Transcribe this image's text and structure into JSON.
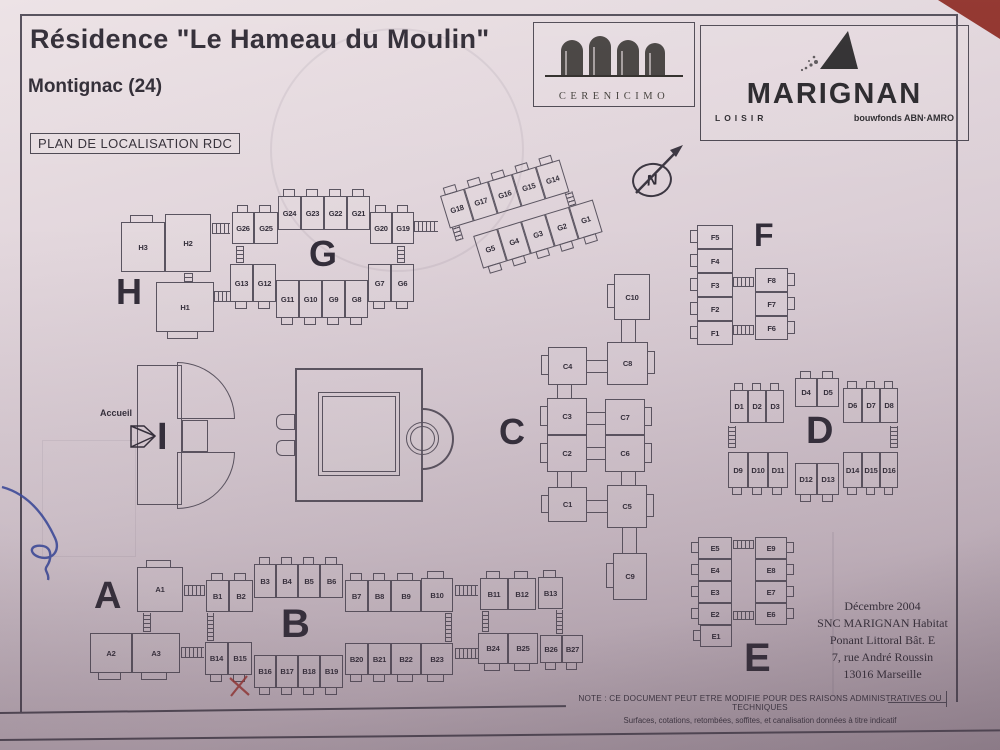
{
  "document": {
    "title": "Résidence \"Le Hameau du Moulin\"",
    "location": "Montignac (24)",
    "plan_label": "PLAN DE LOCALISATION RDC",
    "reception_label": "Accueil",
    "compass_label": "N"
  },
  "logos": {
    "cerenicimo": {
      "name": "CERENICIMO"
    },
    "marignan": {
      "name": "MARIGNAN",
      "tagline_left": "LOISIR",
      "tagline_right": "bouwfonds ABN·AMRO"
    }
  },
  "buildings": [
    {
      "letter": "A",
      "units": [
        "A1",
        "A2",
        "A3"
      ]
    },
    {
      "letter": "B",
      "units": [
        "B1",
        "B2",
        "B3",
        "B4",
        "B5",
        "B6",
        "B7",
        "B8",
        "B9",
        "B10",
        "B11",
        "B12",
        "B13",
        "B14",
        "B15",
        "B16",
        "B17",
        "B18",
        "B19",
        "B20",
        "B21",
        "B22",
        "B23",
        "B24",
        "B25",
        "B26",
        "B27"
      ]
    },
    {
      "letter": "C",
      "units": [
        "C1",
        "C2",
        "C3",
        "C4",
        "C5",
        "C6",
        "C7",
        "C8",
        "C9",
        "C10"
      ]
    },
    {
      "letter": "D",
      "units": [
        "D1",
        "D2",
        "D3",
        "D4",
        "D5",
        "D6",
        "D7",
        "D8",
        "D9",
        "D10",
        "D11",
        "D12",
        "D13",
        "D14",
        "D15",
        "D16"
      ]
    },
    {
      "letter": "E",
      "units": [
        "E1",
        "E2",
        "E3",
        "E4",
        "E5",
        "E6",
        "E7",
        "E8",
        "E9"
      ]
    },
    {
      "letter": "F",
      "units": [
        "F1",
        "F2",
        "F3",
        "F4",
        "F5",
        "F6",
        "F7",
        "F8"
      ]
    },
    {
      "letter": "G",
      "units": [
        "G1",
        "G2",
        "G3",
        "G4",
        "G5",
        "G6",
        "G7",
        "G8",
        "G9",
        "G10",
        "G11",
        "G12",
        "G13",
        "G14",
        "G15",
        "G16",
        "G17",
        "G18",
        "G19",
        "G20",
        "G21",
        "G22",
        "G23",
        "G24",
        "G25",
        "G26"
      ]
    },
    {
      "letter": "H",
      "units": [
        "H1",
        "H2",
        "H3"
      ]
    },
    {
      "letter": "I",
      "units": []
    }
  ],
  "footer": {
    "date": "Décembre 2004",
    "lines": [
      "SNC MARIGNAN Habitat",
      "Ponant Littoral Bât. E",
      "7, rue André Roussin",
      "13016 Marseille"
    ],
    "note_line1": "NOTE : CE DOCUMENT PEUT ETRE MODIFIE POUR DES RAISONS ADMINISTRATIVES OU TECHNIQUES",
    "note_line2": "Surfaces, cotations, retombées, soffites, et canalisation données à titre indicatif"
  },
  "colors": {
    "paper": "#ddd0d6",
    "ink": "#5a5460",
    "text": "#332e3a",
    "backdrop_red": "#8f2f28",
    "pen_blue": "#3b4b9e",
    "mark_red": "#a23732"
  }
}
